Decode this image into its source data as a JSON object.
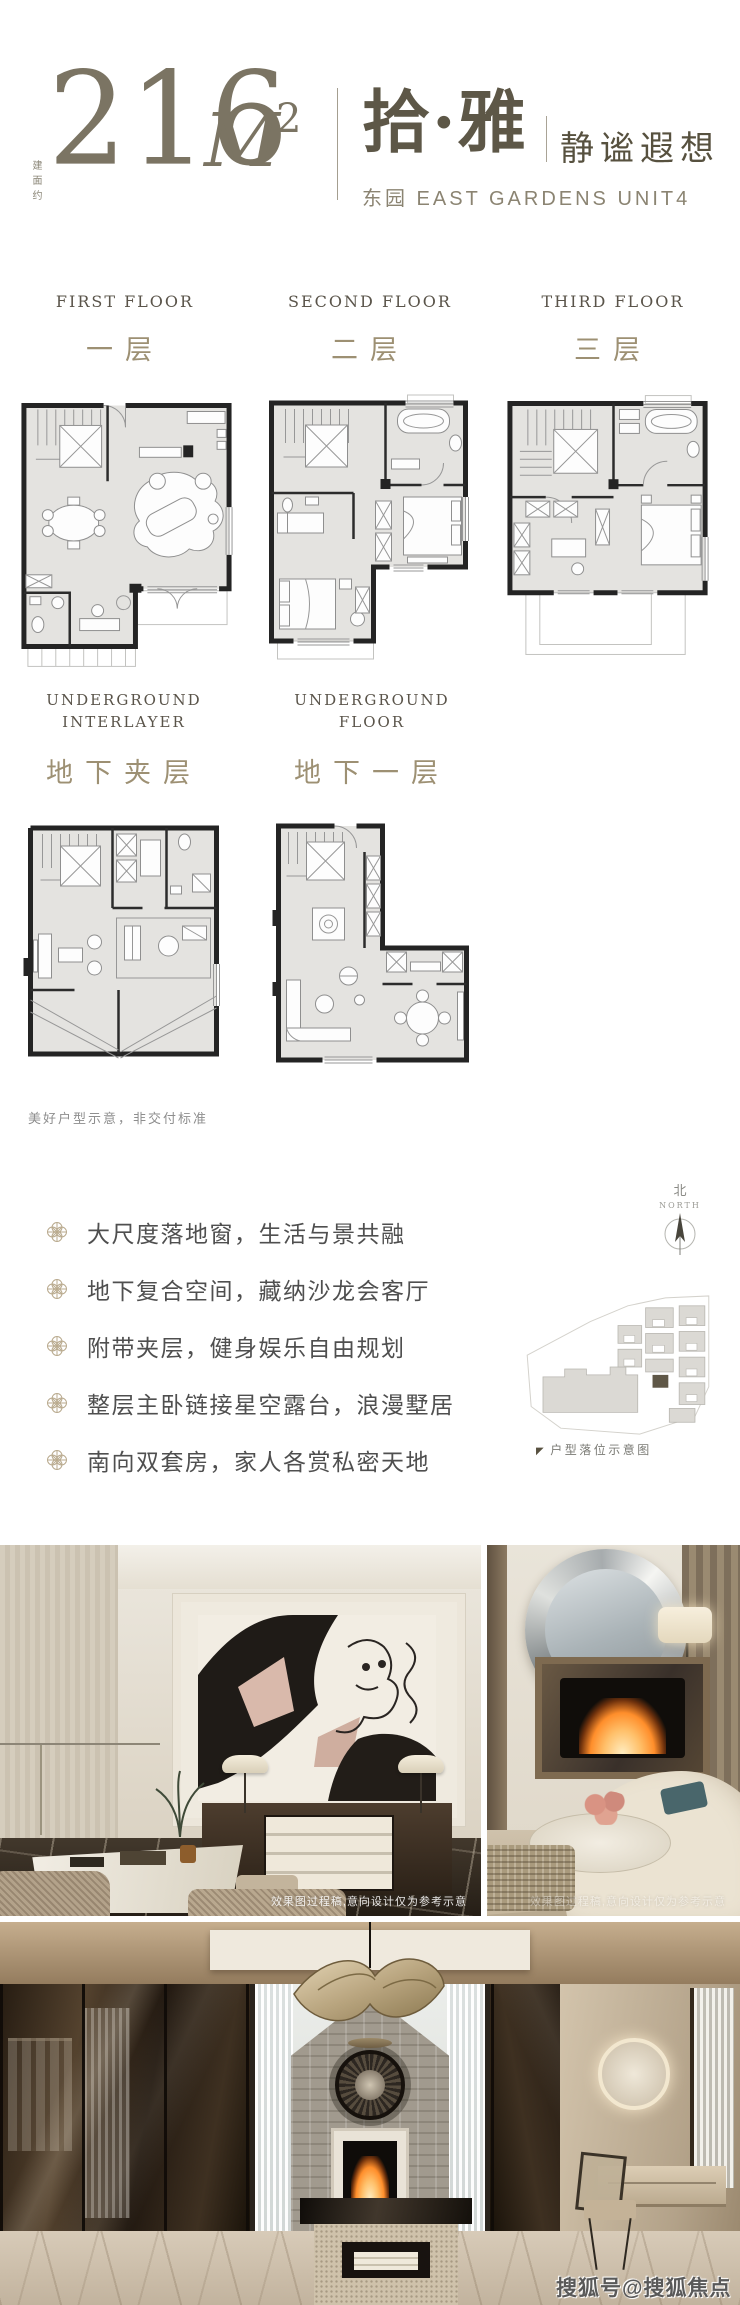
{
  "header": {
    "area_prefix": "建面约",
    "area_value": "216",
    "area_unit": "M",
    "area_sup": "2",
    "name_cn": "拾·雅",
    "tagline": "静谧遐想",
    "subtitle": "东园 EAST GARDENS UNIT4"
  },
  "floors": [
    {
      "label_en": "FIRST FLOOR",
      "label_cn": "一层"
    },
    {
      "label_en": "SECOND FLOOR",
      "label_cn": "二层"
    },
    {
      "label_en": "THIRD FLOOR",
      "label_cn": "三层"
    },
    {
      "label_en": "UNDERGROUND INTERLAYER",
      "label_cn": "地下夹层"
    },
    {
      "label_en": "UNDERGROUND FLOOR",
      "label_cn": "地下一层"
    }
  ],
  "disclaimer": "美好户型示意，非交付标准",
  "features": [
    {
      "text": "大尺度落地窗，生活与景共融"
    },
    {
      "text": "地下复合空间，藏纳沙龙会客厅"
    },
    {
      "text": "附带夹层，健身娱乐自由规划"
    },
    {
      "text": "整层主卧链接星空露台，浪漫墅居"
    },
    {
      "text": "南向双套房，家人各赏私密天地"
    }
  ],
  "compass": {
    "label_cn": "北",
    "label_en": "NORTH"
  },
  "siteplan": {
    "marker": "◤",
    "caption": "户型落位示意图"
  },
  "photos": {
    "render_note": "效果图过程稿,意向设计仅为参考示意"
  },
  "watermark": "搜狐号@搜狐焦点鄂州站",
  "colors": {
    "accent_taupe": "#7b7463",
    "label_gold": "#9d9073",
    "plan_wall": "#242424",
    "plan_floor": "#e4e3e0",
    "highlight_unit": "#5f5747"
  }
}
